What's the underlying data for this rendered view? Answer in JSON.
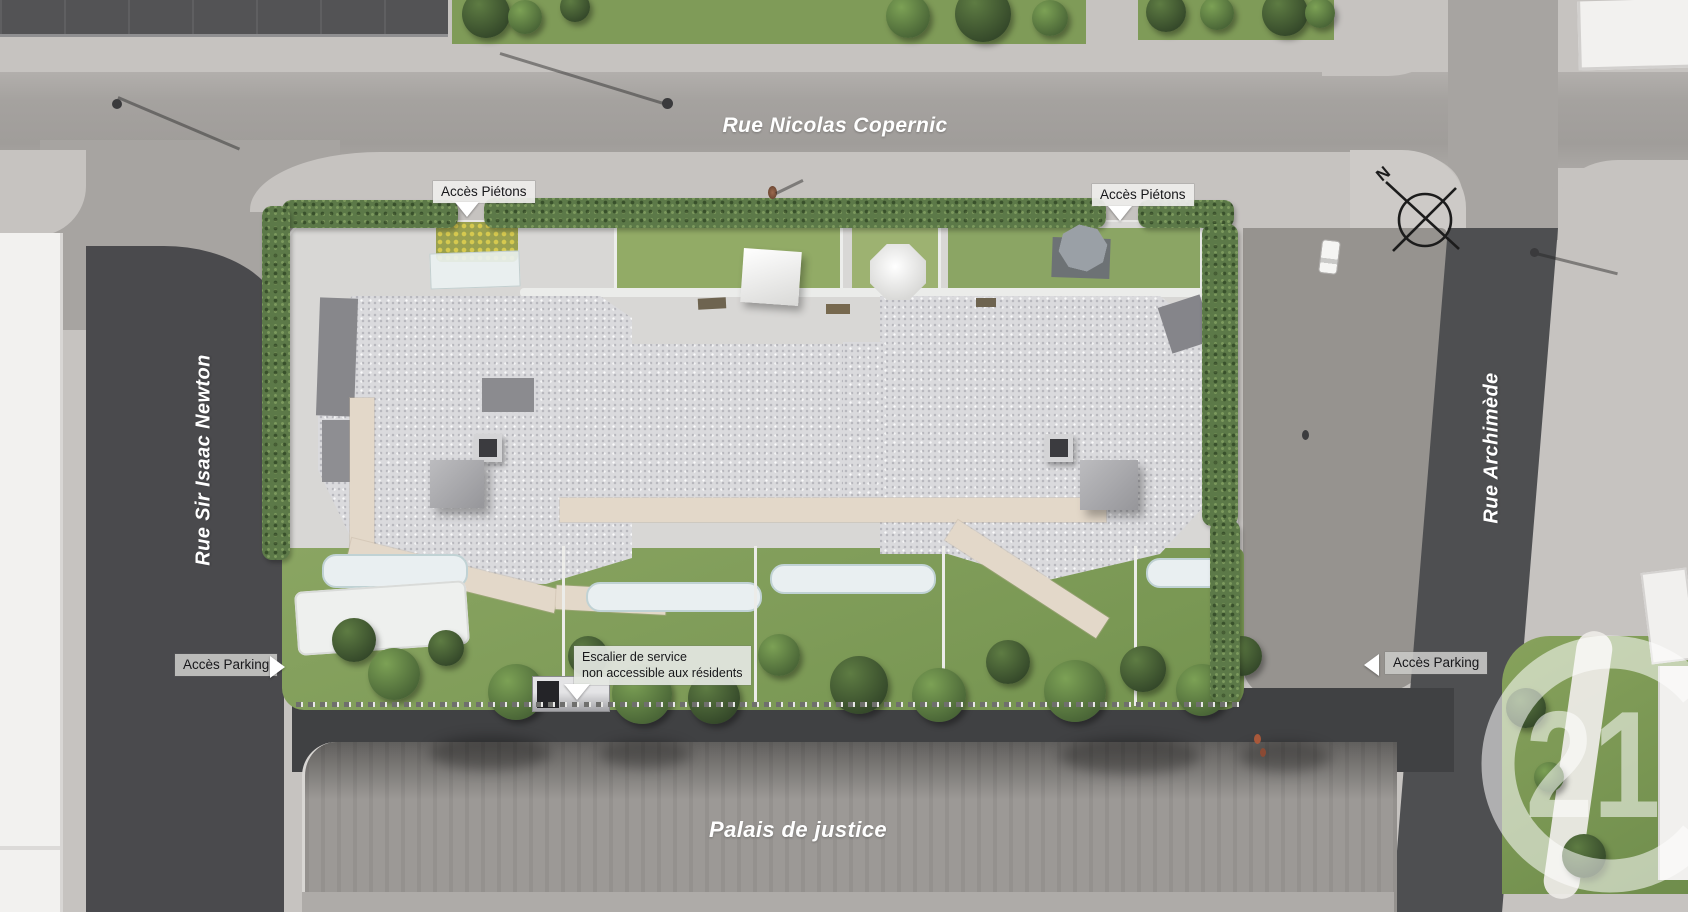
{
  "scene": {
    "streets": {
      "top": "Rue Nicolas Copernic",
      "left": "Rue Sir Isaac Newton",
      "right": "Rue Archimède"
    },
    "landmarks": {
      "bottom": "Palais de justice"
    },
    "annotations": {
      "pedestrian_access_left": "Accès Piétons",
      "pedestrian_access_right": "Accès Piétons",
      "parking_access_left": "Accès Parking",
      "parking_access_right": "Accès Parking",
      "service_stair_line1": "Escalier de service",
      "service_stair_line2": "non accessible aux résidents"
    },
    "compass": {
      "north": "N"
    },
    "watermark": {
      "number": "21"
    },
    "palette": {
      "road_dark": "#4a4a4d",
      "road_light": "#a5a29f",
      "pavement": "#c6c3c0",
      "roof_gravel": "#dadadd",
      "walkway_beige": "#e3d8c9",
      "hedge_green": "#5c7948",
      "lawn_green": "#84a05e",
      "plaza_gray": "#9c9996",
      "label_bg": "#eeeeeb",
      "label_text": "#17171a"
    }
  }
}
